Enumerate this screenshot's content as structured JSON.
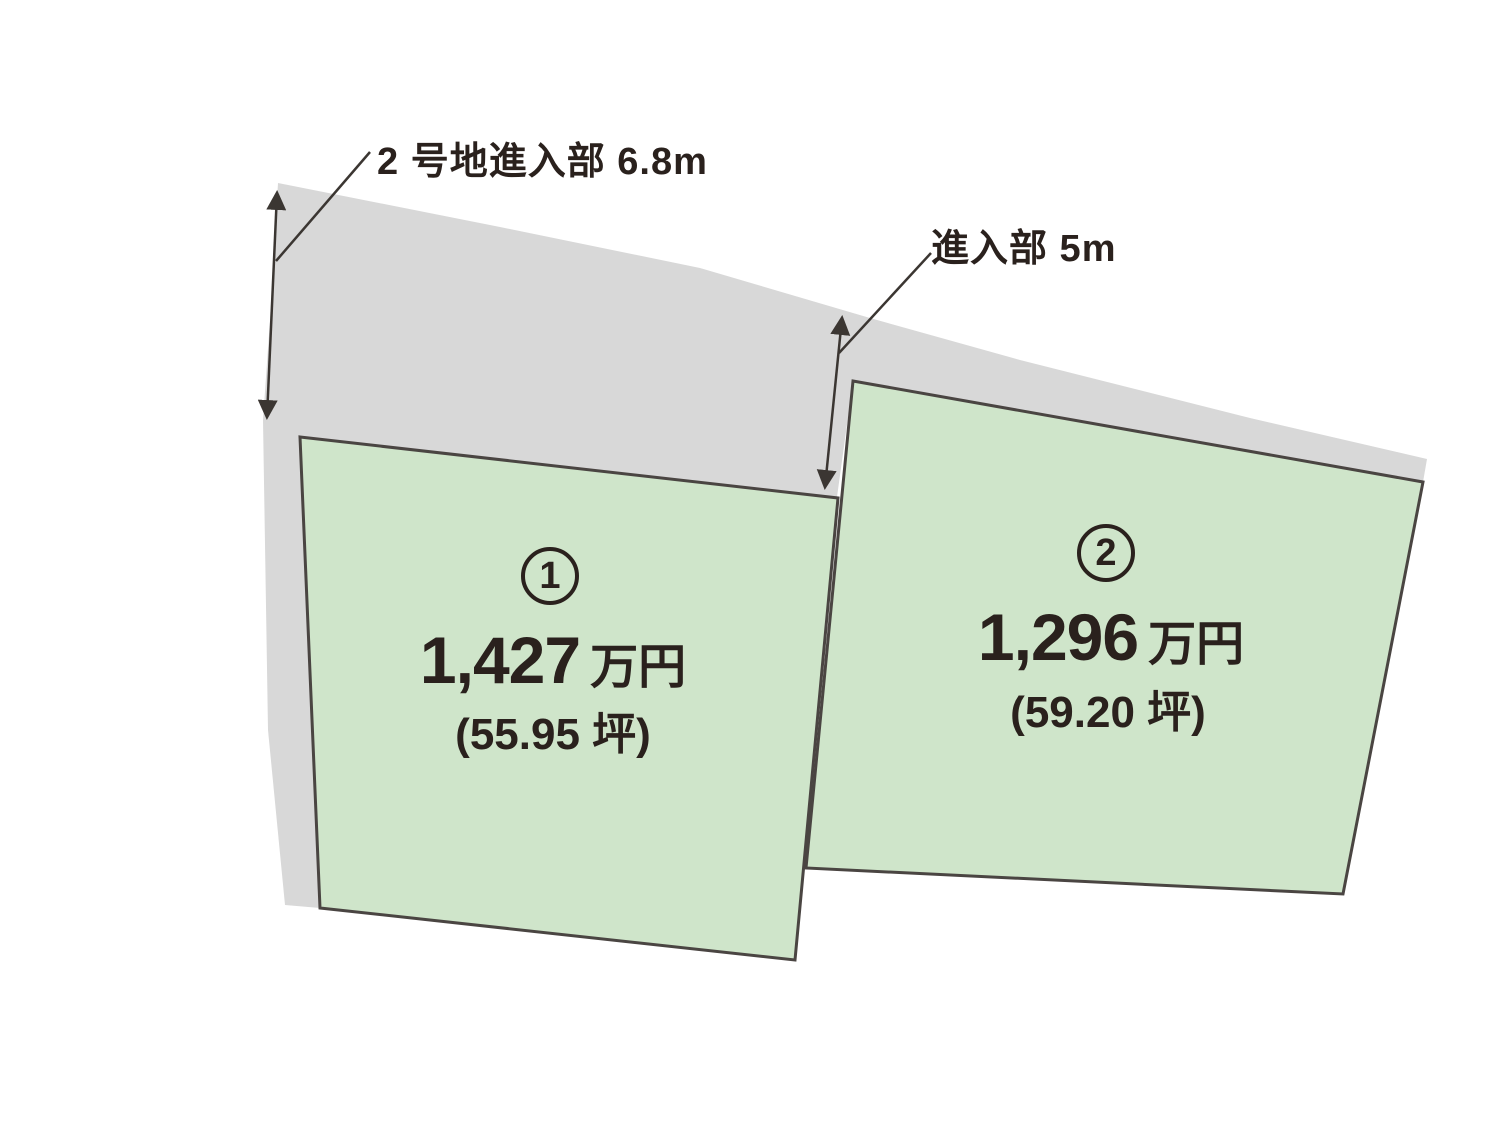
{
  "diagram": {
    "type": "land-plot-layout",
    "colors": {
      "road_fill": "#d8d8d8",
      "plot_fill": "#cfe5ca",
      "plot_outline": "#4a4542",
      "arrow": "#3b3632",
      "text": "#2a211d",
      "background": "#ffffff"
    },
    "annotations": [
      {
        "id": "entrance-left",
        "label": "2 号地進入部 6.8m"
      },
      {
        "id": "entrance-mid",
        "label": "進入部 5m"
      }
    ],
    "plots": [
      {
        "number": "1",
        "price_value": "1,427",
        "price_unit": "万円",
        "area": "(55.95 坪)"
      },
      {
        "number": "2",
        "price_value": "1,296",
        "price_unit": "万円",
        "area": "(59.20 坪)"
      }
    ]
  }
}
